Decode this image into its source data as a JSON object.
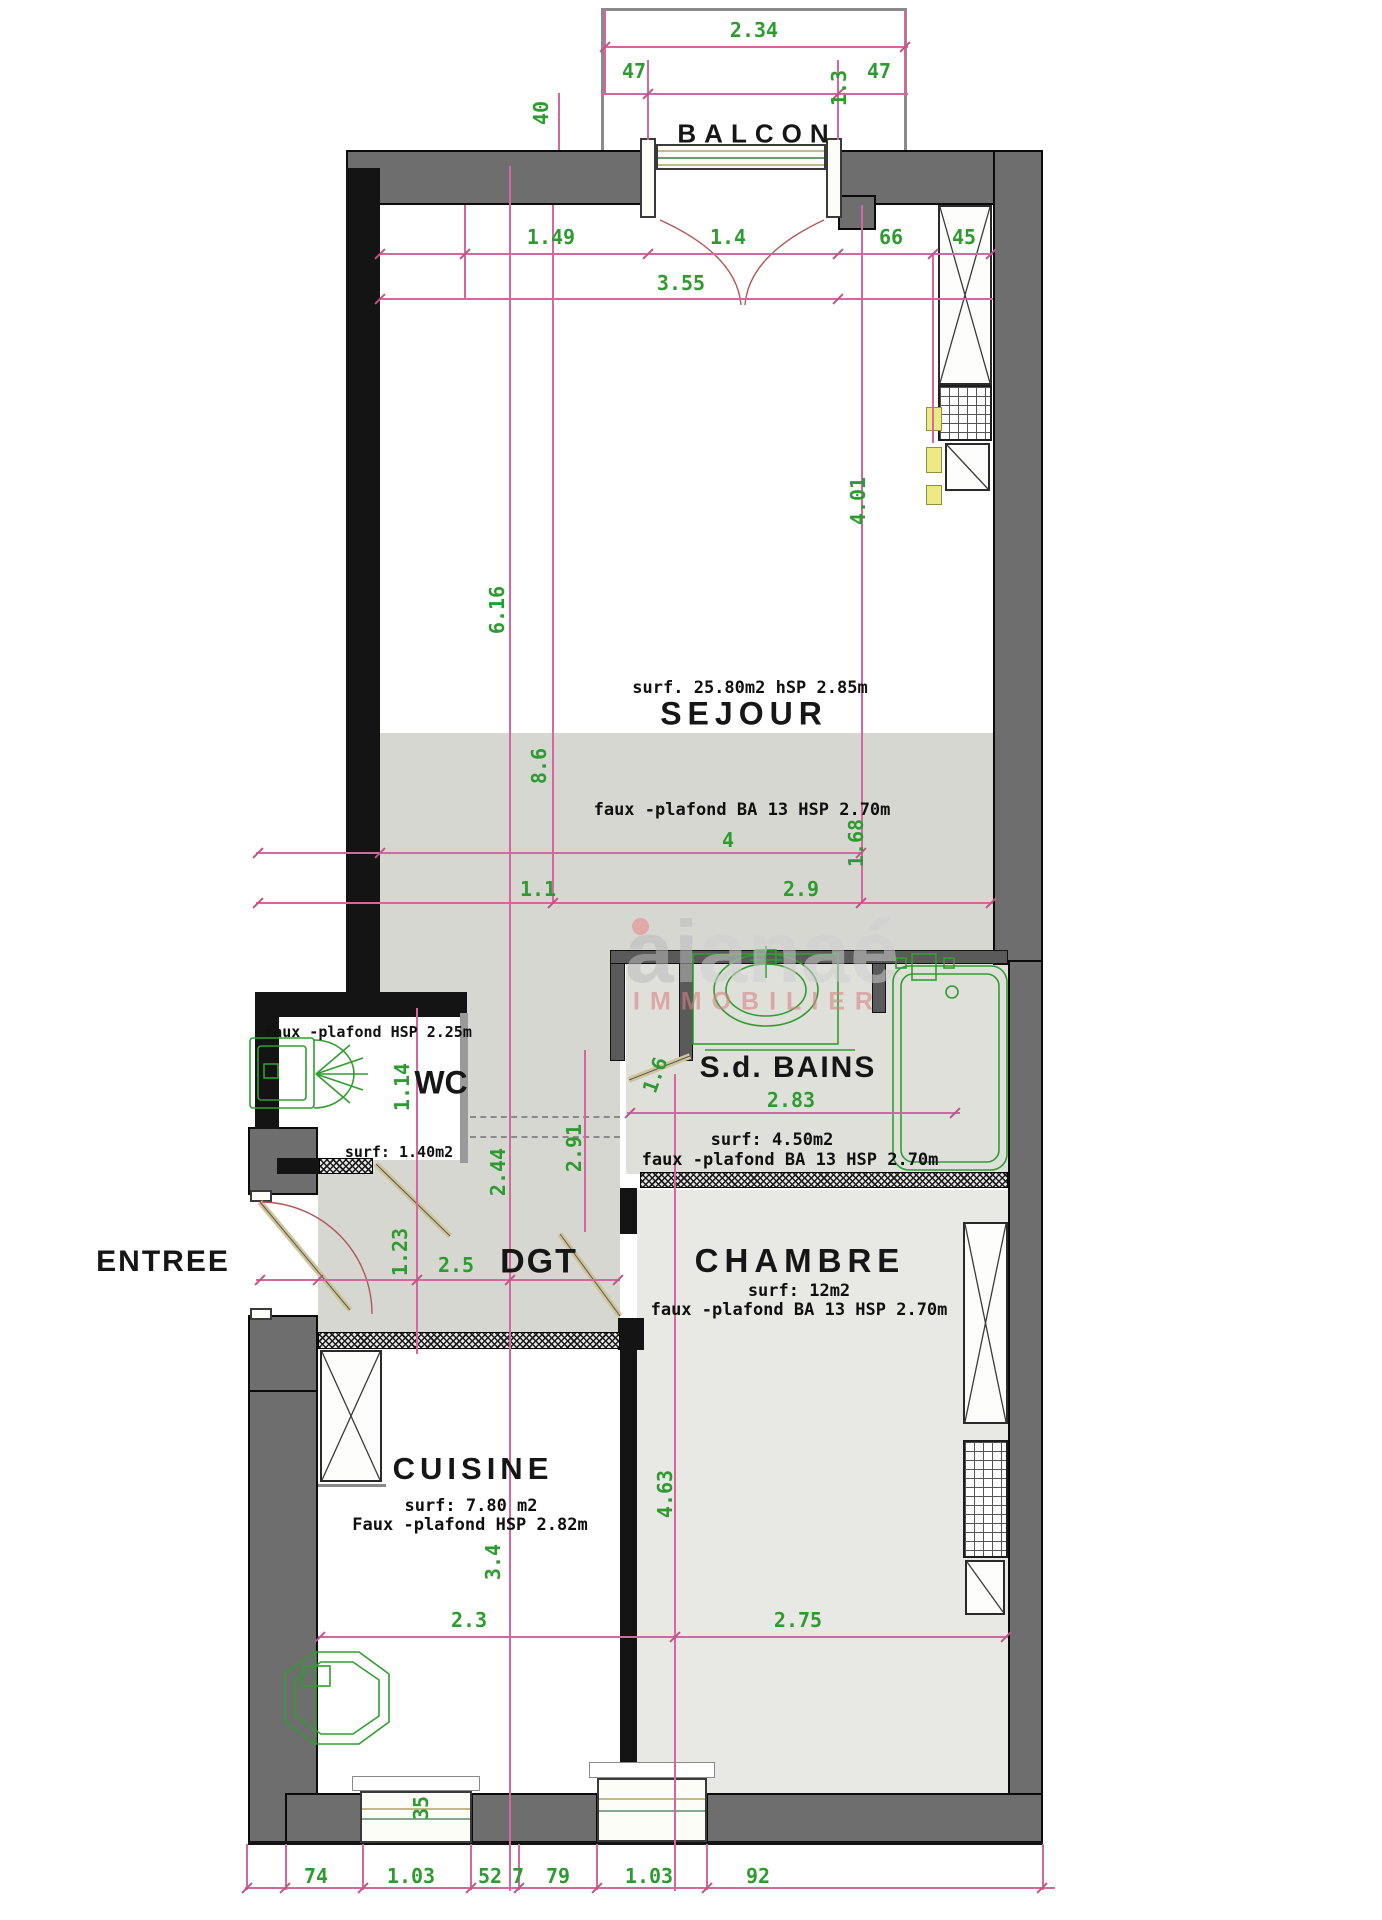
{
  "rooms": {
    "balcon": {
      "label": "BALCON"
    },
    "sejour": {
      "label": "SEJOUR",
      "surface": "surf. 25.80m2  hSP 2.85m",
      "ceiling": "faux -plafond BA 13 HSP 2.70m"
    },
    "wc": {
      "label": "WC",
      "surface": "surf: 1.40m2",
      "ceiling": "faux -plafond HSP 2.25m"
    },
    "sdb": {
      "label": "S.d. BAINS",
      "surface": "surf: 4.50m2",
      "ceiling": "faux -plafond BA 13 HSP 2.70m"
    },
    "entree": {
      "label": "ENTREE"
    },
    "dgt": {
      "label": "DGT"
    },
    "chambre": {
      "label": "CHAMBRE",
      "surface": "surf: 12m2",
      "ceiling": "faux -plafond BA 13 HSP 2.70m"
    },
    "cuisine": {
      "label": "CUISINE",
      "surface": "surf: 7.80 m2",
      "ceiling": "Faux -plafond HSP 2.82m"
    }
  },
  "dim_texts": [
    "2.34",
    "47",
    "1.3",
    "47",
    "40",
    "1.49",
    "1.4",
    "66",
    "45",
    "3.55",
    "4.01",
    "6.16",
    "8.6",
    "4",
    "1.68",
    "1.1",
    "2.9",
    "1.14",
    "1.6",
    "2.83",
    "2.44",
    "2.91",
    "1.23",
    "2.5",
    "4.63",
    "3.4",
    "2.3",
    "2.75",
    "35",
    "74",
    "1.03",
    "52",
    "7",
    "79",
    "1.03",
    "92"
  ],
  "watermark": {
    "brand_left": "ai",
    "brand_right": "anaé",
    "sub": "IMMOBILIER"
  },
  "colors": {
    "dim_green": "#2e9b30",
    "dim_pink": "#d4679f",
    "wall_gray": "#6e6e6e",
    "zone_gray": "#d7d7d2",
    "fixture_green": "#2f9e2f"
  }
}
